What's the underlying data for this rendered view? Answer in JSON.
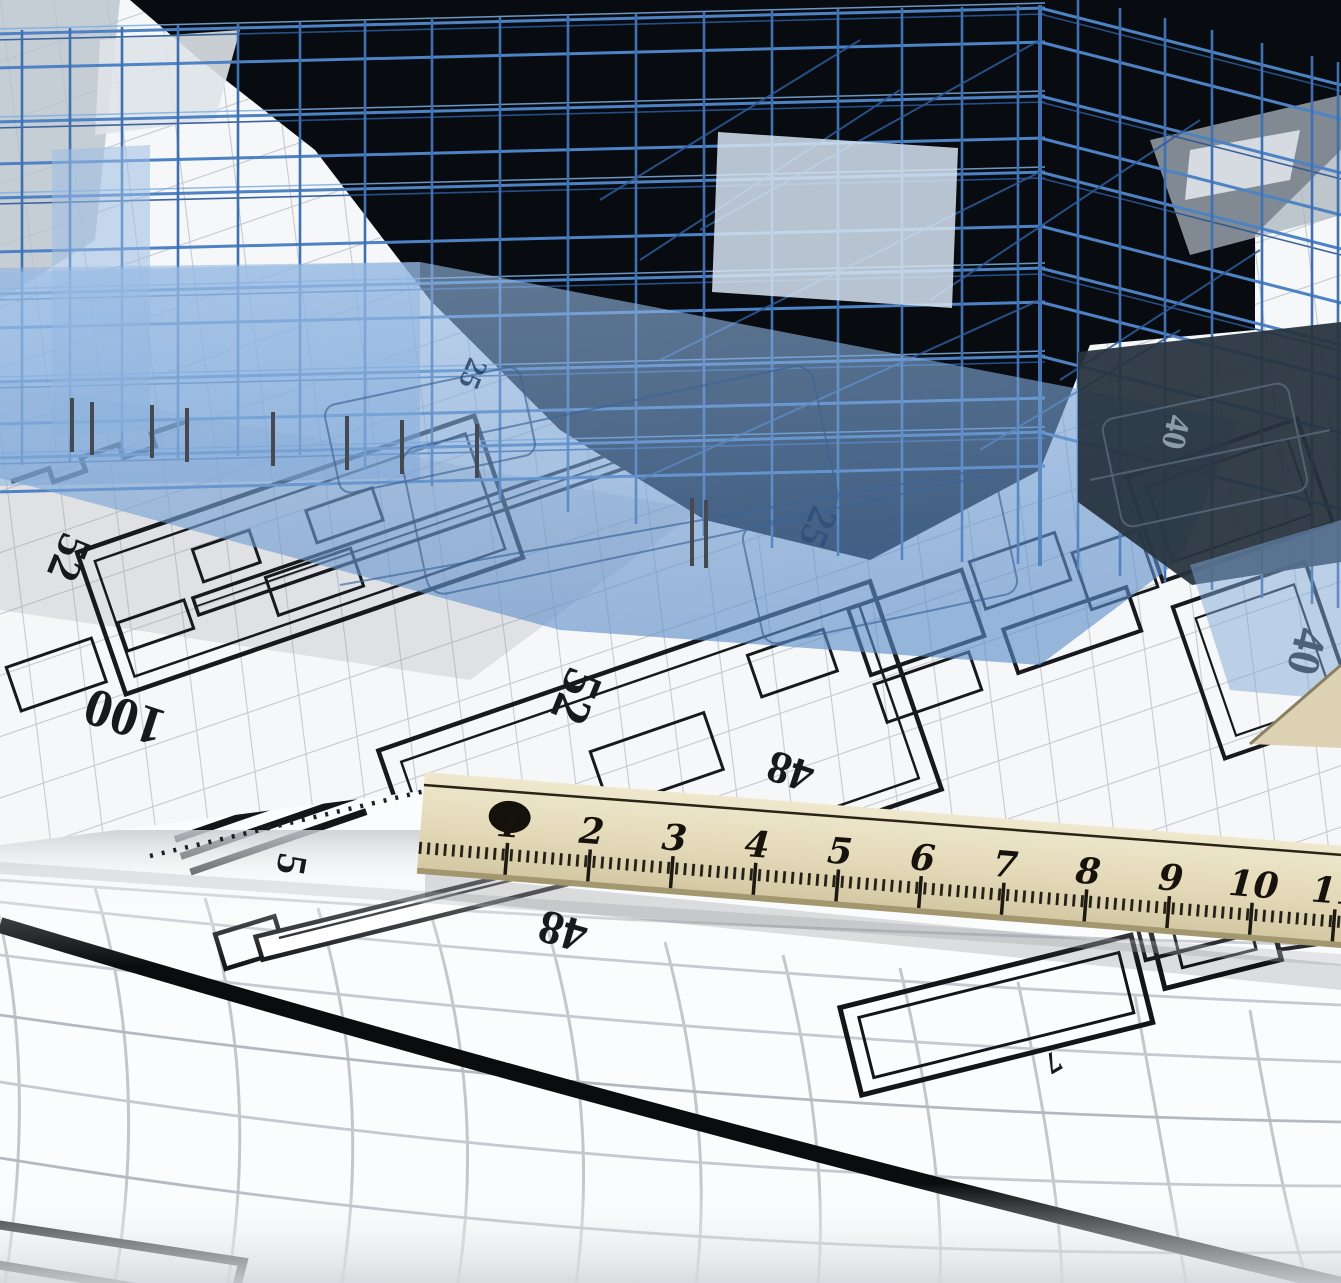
{
  "scene": {
    "subject": "3D wireframe architectural model standing over rolled blueprint plans with a wooden ruler",
    "style": "photorealistic architectural visualization"
  },
  "palette": {
    "paper": "#f6f7f8",
    "grid_line": "#bfc4cb",
    "plan_ink": "#17191d",
    "wireframe_blue": "#4d82c4",
    "wireframe_dark_blue": "#2a5694",
    "glass_blue": "#86aedd",
    "glass_dark": "#27333f",
    "void_black": "#080b10",
    "ruler_wood": "#e7dfc2",
    "ruler_ink": "#1c1812",
    "border_ink": "#0b0c0e"
  },
  "blueprint_annotations": [
    {
      "text": "52",
      "color": "#17191d"
    },
    {
      "text": "100",
      "color": "#17191d"
    },
    {
      "text": "52",
      "color": "#17191d"
    },
    {
      "text": "48",
      "color": "#17191d"
    },
    {
      "text": "40",
      "color": "#17191d"
    },
    {
      "text": "5",
      "color": "#17191d"
    },
    {
      "text": "48",
      "color": "#17191d"
    },
    {
      "text": "25",
      "color": "#2e4d79"
    },
    {
      "text": "25",
      "color": "#1f3a63"
    },
    {
      "text": "40",
      "color": "#99a6b4"
    },
    {
      "text": "7",
      "color": "#17191d"
    }
  ],
  "ruler": {
    "numbers": [
      "1",
      "2",
      "3",
      "4",
      "5",
      "6",
      "7",
      "8",
      "9",
      "10",
      "11"
    ],
    "hole": "black round hanging hole at left end"
  }
}
